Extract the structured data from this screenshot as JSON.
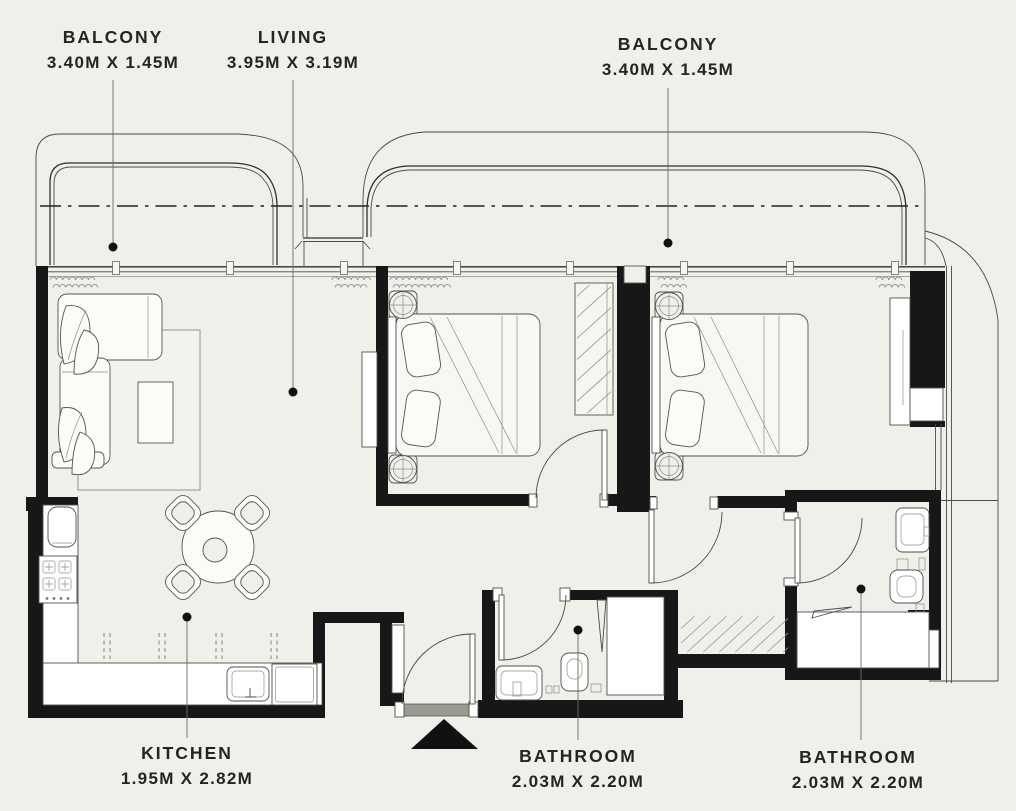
{
  "colors": {
    "background": "#f0efe9",
    "walls": "#171717",
    "fixtures": "#ffffff",
    "entry_sill": "#9b9b93",
    "lines": "#4a4a48",
    "label_text": "#242422"
  },
  "labels": {
    "balcony_left": {
      "name": "BALCONY",
      "dims": "3.40M X 1.45M"
    },
    "living": {
      "name": "LIVING",
      "dims": "3.95M X 3.19M"
    },
    "balcony_right": {
      "name": "BALCONY",
      "dims": "3.40M X 1.45M"
    },
    "kitchen": {
      "name": "KITCHEN",
      "dims": "1.95M X 2.82M"
    },
    "bathroom_middle": {
      "name": "BATHROOM",
      "dims": "2.03M X 2.20M"
    },
    "bathroom_right": {
      "name": "BATHROOM",
      "dims": "2.03M X 2.20M"
    }
  }
}
